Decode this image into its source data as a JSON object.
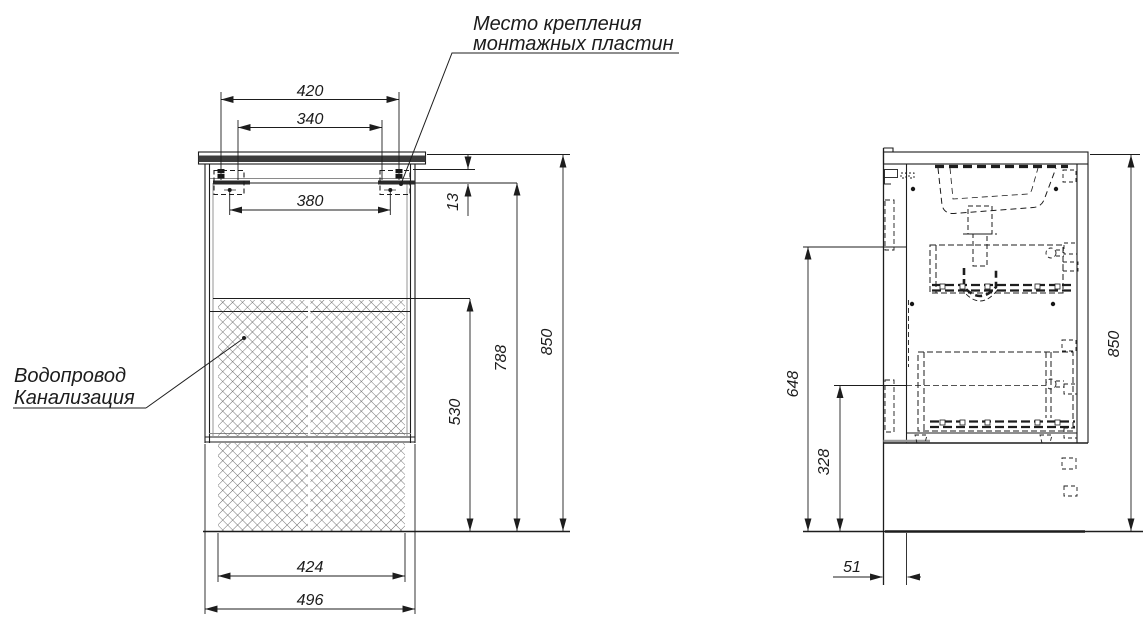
{
  "labels": {
    "mounting_plates": {
      "line1": "Место крепления",
      "line2": "монтажных пластин"
    },
    "plumbing": {
      "line1": "Водопровод",
      "line2": "Канализация"
    }
  },
  "front_view": {
    "dims": {
      "top_outer": "420",
      "top_inner": "340",
      "plate_span": "380",
      "plate_offset": "13",
      "riser_zone_height": "530",
      "plate_height": "788",
      "total_height": "850",
      "riser_zone_width": "424",
      "cabinet_width": "496"
    }
  },
  "side_view": {
    "dims": {
      "upper_height": "648",
      "lower_height": "328",
      "total_height": "850",
      "wall_gap": "51"
    }
  },
  "colors": {
    "line": "#1d1d1d",
    "hatch": "#4a4a4a",
    "countertop_fill": "#3c3c3c"
  }
}
